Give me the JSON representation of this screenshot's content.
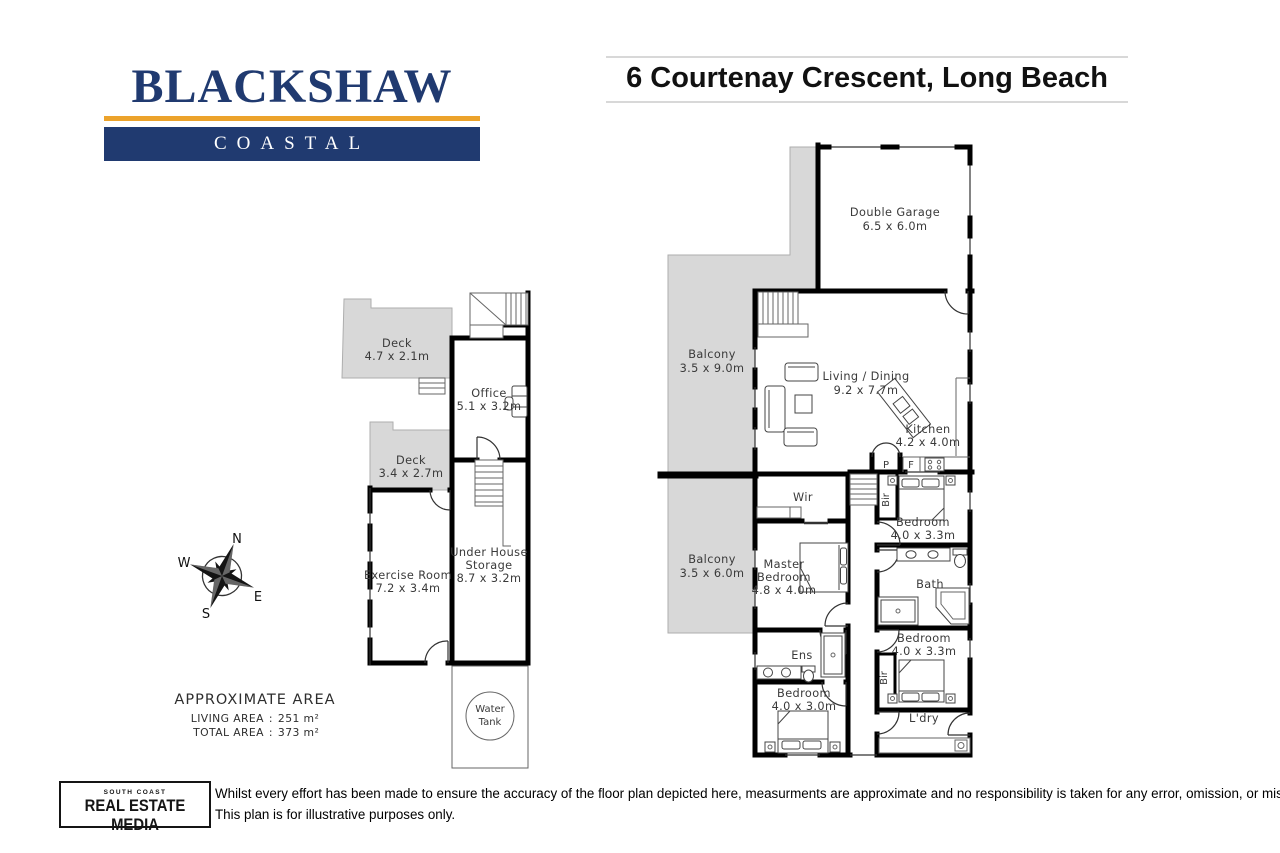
{
  "header": {
    "brand": "BLACKSHAW",
    "brand_sub": "COASTAL",
    "address": "6 Courtenay Crescent, Long Beach"
  },
  "colors": {
    "navy": "#203a70",
    "gold": "#eca32b",
    "deck_gray": "#d8d8d8",
    "wall": "#000000"
  },
  "lower_plan": {
    "deck1": {
      "name": "Deck",
      "dims": "4.7 x 2.1m"
    },
    "office": {
      "name": "Office",
      "dims": "5.1 x 3.2m"
    },
    "deck2": {
      "name": "Deck",
      "dims": "3.4 x 2.7m"
    },
    "exercise": {
      "name": "Exercise Room",
      "dims": "7.2 x 3.4m"
    },
    "storage": {
      "line1": "Under House",
      "line2": "Storage",
      "dims": "8.7 x 3.2m"
    },
    "water_tank": {
      "line1": "Water",
      "line2": "Tank"
    }
  },
  "upper_plan": {
    "garage": {
      "name": "Double Garage",
      "dims": "6.5 x 6.0m"
    },
    "balcony1": {
      "name": "Balcony",
      "dims": "3.5 x 9.0m"
    },
    "living": {
      "name": "Living / Dining",
      "dims": "9.2 x 7.7m"
    },
    "kitchen": {
      "name": "Kitchen",
      "dims": "4.2 x 4.0m"
    },
    "pantry": "P",
    "fridge": "F",
    "wir": "Wir",
    "bir": "Bir",
    "balcony2": {
      "name": "Balcony",
      "dims": "3.5 x 6.0m"
    },
    "master": {
      "line1": "Master",
      "line2": "Bedroom",
      "dims": "4.8 x 4.0m"
    },
    "bedroom1": {
      "name": "Bedroom",
      "dims": "4.0 x 3.3m"
    },
    "bath": "Bath",
    "ens": "Ens",
    "bedroom2": {
      "name": "Bedroom",
      "dims": "4.0 x 3.3m"
    },
    "bedroom3": {
      "name": "Bedroom",
      "dims": "4.0 x 3.0m"
    },
    "laundry": "L'dry"
  },
  "compass": {
    "n": "N",
    "e": "E",
    "s": "S",
    "w": "W"
  },
  "area": {
    "title": "APPROXIMATE AREA",
    "living_label": "LIVING  AREA",
    "living_sep": ":",
    "living_value": "251 m²",
    "total_label": "TOTAL AREA",
    "total_sep": ":",
    "total_value": "373 m²"
  },
  "footer": {
    "logo_top": "SOUTH COAST",
    "logo_main": "REAL ESTATE MEDIA",
    "disclaimer1": "Whilst every effort has been made to ensure the accuracy of the floor plan depicted here, measurments are approximate and no responsibility is taken for any error, omission, or mis statement.",
    "disclaimer2": "This plan is for illustrative purposes only."
  }
}
